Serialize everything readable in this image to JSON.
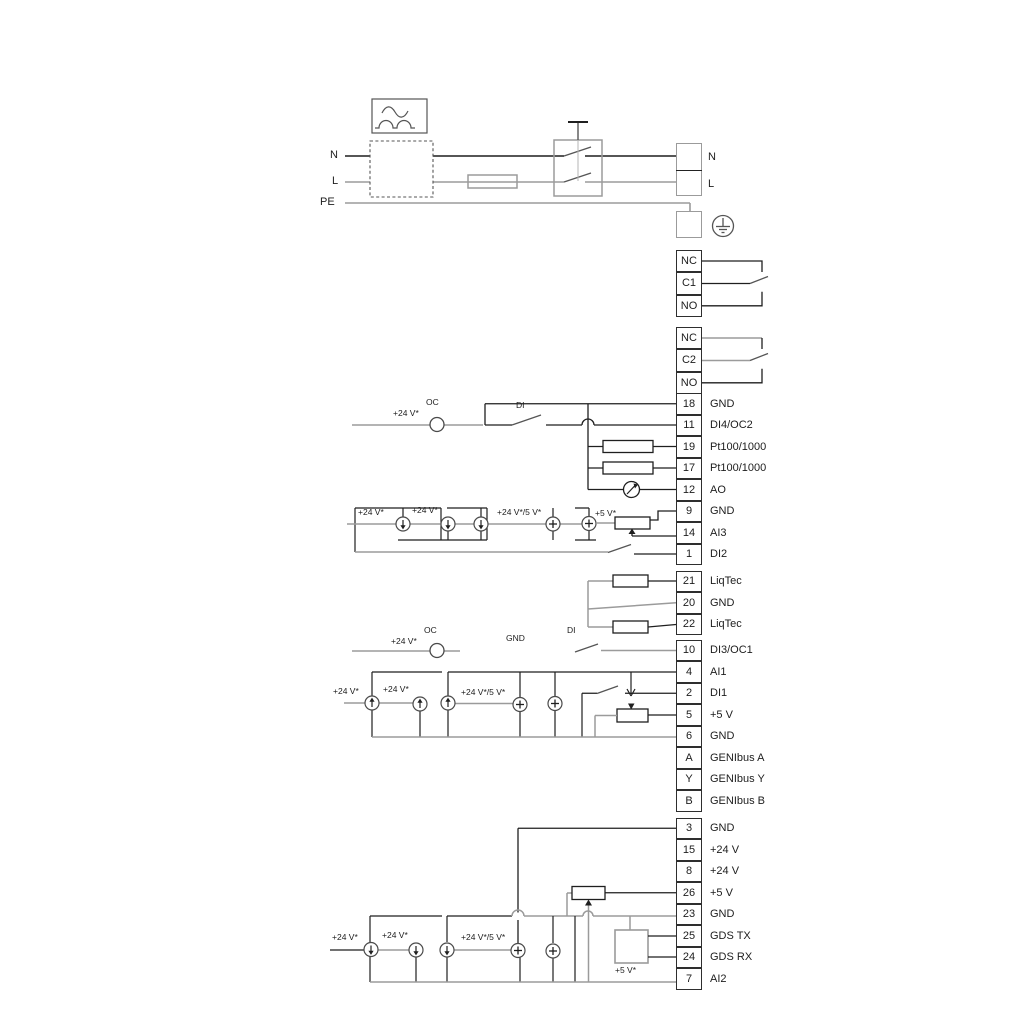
{
  "power": {
    "n_left": "N",
    "l_left": "L",
    "pe": "PE",
    "n_right": "N",
    "l_right": "L"
  },
  "relays": [
    {
      "rows": [
        "NC",
        "C1",
        "NO"
      ]
    },
    {
      "rows": [
        "NC",
        "C2",
        "NO"
      ]
    }
  ],
  "terminal_groups": {
    "upper": {
      "rows": [
        {
          "num": "18",
          "label": "GND"
        },
        {
          "num": "11",
          "label": "DI4/OC2"
        },
        {
          "num": "19",
          "label": "Pt100/1000"
        },
        {
          "num": "17",
          "label": "Pt100/1000"
        },
        {
          "num": "12",
          "label": "AO"
        },
        {
          "num": "9",
          "label": "GND"
        },
        {
          "num": "14",
          "label": "AI3"
        },
        {
          "num": "1",
          "label": "DI2"
        }
      ]
    },
    "liqtec": {
      "rows": [
        {
          "num": "21",
          "label": "LiqTec"
        },
        {
          "num": "20",
          "label": "GND"
        },
        {
          "num": "22",
          "label": "LiqTec"
        }
      ]
    },
    "mid": {
      "rows": [
        {
          "num": "10",
          "label": "DI3/OC1"
        },
        {
          "num": "4",
          "label": "AI1"
        },
        {
          "num": "2",
          "label": "DI1"
        },
        {
          "num": "5",
          "label": "+5 V"
        },
        {
          "num": "6",
          "label": "GND"
        },
        {
          "num": "A",
          "label": "GENIbus A"
        },
        {
          "num": "Y",
          "label": "GENIbus Y"
        },
        {
          "num": "B",
          "label": "GENIbus B"
        }
      ]
    },
    "lower": {
      "rows": [
        {
          "num": "3",
          "label": "GND"
        },
        {
          "num": "15",
          "label": "+24 V"
        },
        {
          "num": "8",
          "label": "+24 V"
        },
        {
          "num": "26",
          "label": "+5 V"
        },
        {
          "num": "23",
          "label": "GND"
        },
        {
          "num": "25",
          "label": "GDS TX"
        },
        {
          "num": "24",
          "label": "GDS RX"
        },
        {
          "num": "7",
          "label": "AI2"
        }
      ]
    }
  },
  "annotations": {
    "oc_upper": {
      "supply": "+24 V*",
      "oc": "OC",
      "di": "DI"
    },
    "sources_upper": {
      "v1": "+24 V*",
      "v2": "+24 V*",
      "v3": "+24 V*/5 V*",
      "v4": "+5 V*"
    },
    "oc_mid": {
      "supply": "+24 V*",
      "oc": "OC",
      "gnd": "GND",
      "di": "DI"
    },
    "sources_mid": {
      "v1": "+24 V*",
      "v2": "+24 V*",
      "v3": "+24 V*/5 V*"
    },
    "sources_lower": {
      "v1": "+24 V*",
      "v2": "+24 V*",
      "v3": "+24 V*/5 V*",
      "v4": "+5 V*"
    }
  },
  "colors": {
    "wire_dark": "#1f1f1f",
    "wire_gray": "#9b9b9b",
    "symbol": "#555555"
  }
}
